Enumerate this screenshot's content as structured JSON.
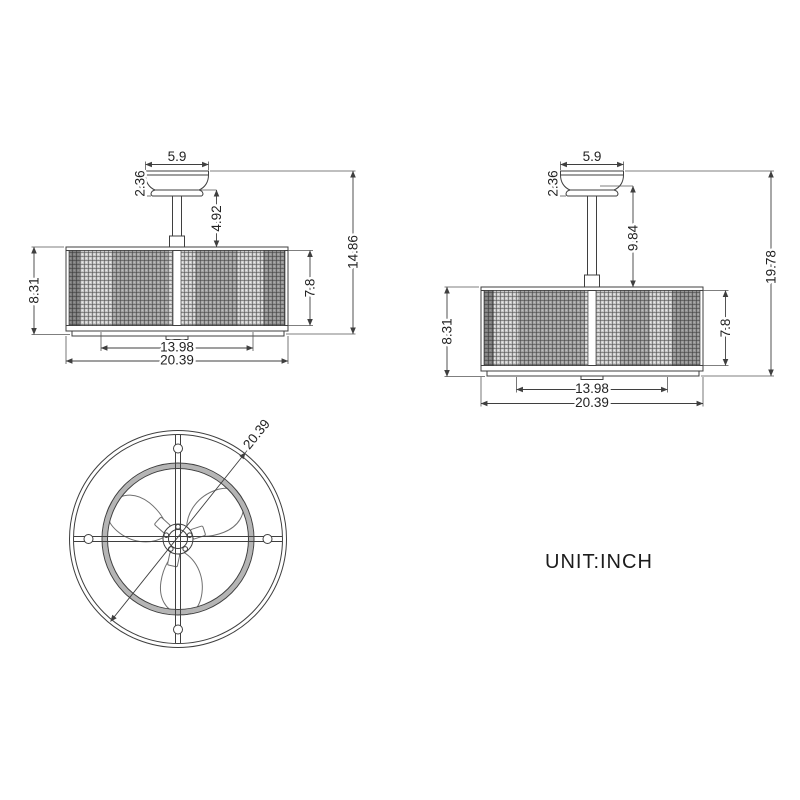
{
  "unit_label": "UNIT:INCH",
  "drawing": {
    "side_view_short": {
      "canopy_width": "5.9",
      "canopy_height": "2.36",
      "downrod_length": "4.92",
      "overall_height": "14.86",
      "cage_height": "8.31",
      "drum_height": "7.8",
      "inner_width": "13.98",
      "overall_width": "20.39"
    },
    "side_view_long": {
      "canopy_width": "5.9",
      "canopy_height": "2.36",
      "downrod_length": "9.84",
      "overall_height": "19.78",
      "cage_height": "8.31",
      "drum_height": "7.8",
      "inner_width": "13.98",
      "overall_width": "20.39"
    },
    "bottom_view": {
      "diameter": "20.39"
    },
    "colors": {
      "line": "#3f3f3f",
      "text": "#232323",
      "background": "#ffffff"
    }
  }
}
